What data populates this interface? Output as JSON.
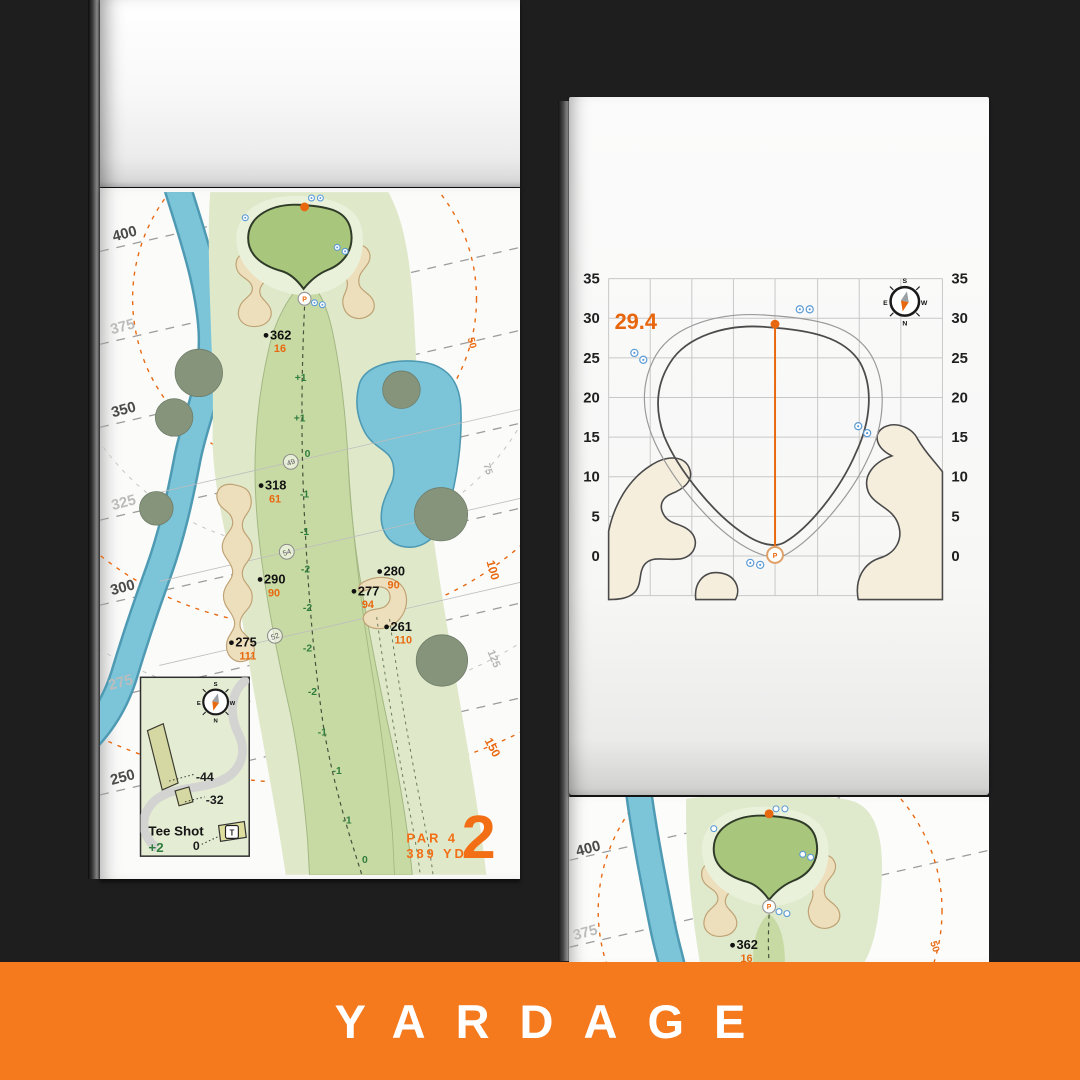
{
  "banner": {
    "label": "YARDAGE"
  },
  "hole": {
    "number": "2",
    "par": "PAR 4",
    "yards": "389 YD",
    "pin": "P",
    "tee_lines": [
      "400",
      "375",
      "350",
      "325",
      "300",
      "275",
      "250"
    ],
    "arcs": [
      "50",
      "75",
      "100",
      "125",
      "150"
    ],
    "markers": [
      {
        "d": "362",
        "c": "16"
      },
      {
        "d": "318",
        "c": "61"
      },
      {
        "d": "290",
        "c": "90"
      },
      {
        "d": "280",
        "c": "90"
      },
      {
        "d": "277",
        "c": "94"
      },
      {
        "d": "261",
        "c": "110"
      },
      {
        "d": "275",
        "c": "111"
      }
    ],
    "center": [
      "+1",
      "+1",
      "0",
      "-1",
      "-1",
      "-2",
      "-2",
      "-2",
      "-2",
      "-1",
      "-1",
      "-1",
      "0"
    ],
    "circles": [
      "49",
      "54",
      "52"
    ],
    "inset": {
      "title": "Tee Shot",
      "score": "+2",
      "zero": "0",
      "len_back": "-44",
      "len_front": "-32",
      "tee": "T"
    }
  },
  "green_page": {
    "depth": "29.4",
    "pin": "P",
    "ticks": [
      "35",
      "30",
      "25",
      "20",
      "15",
      "10",
      "5",
      "0"
    ]
  },
  "compass": {
    "n": "N",
    "s": "S",
    "e": "E",
    "w": "W"
  }
}
